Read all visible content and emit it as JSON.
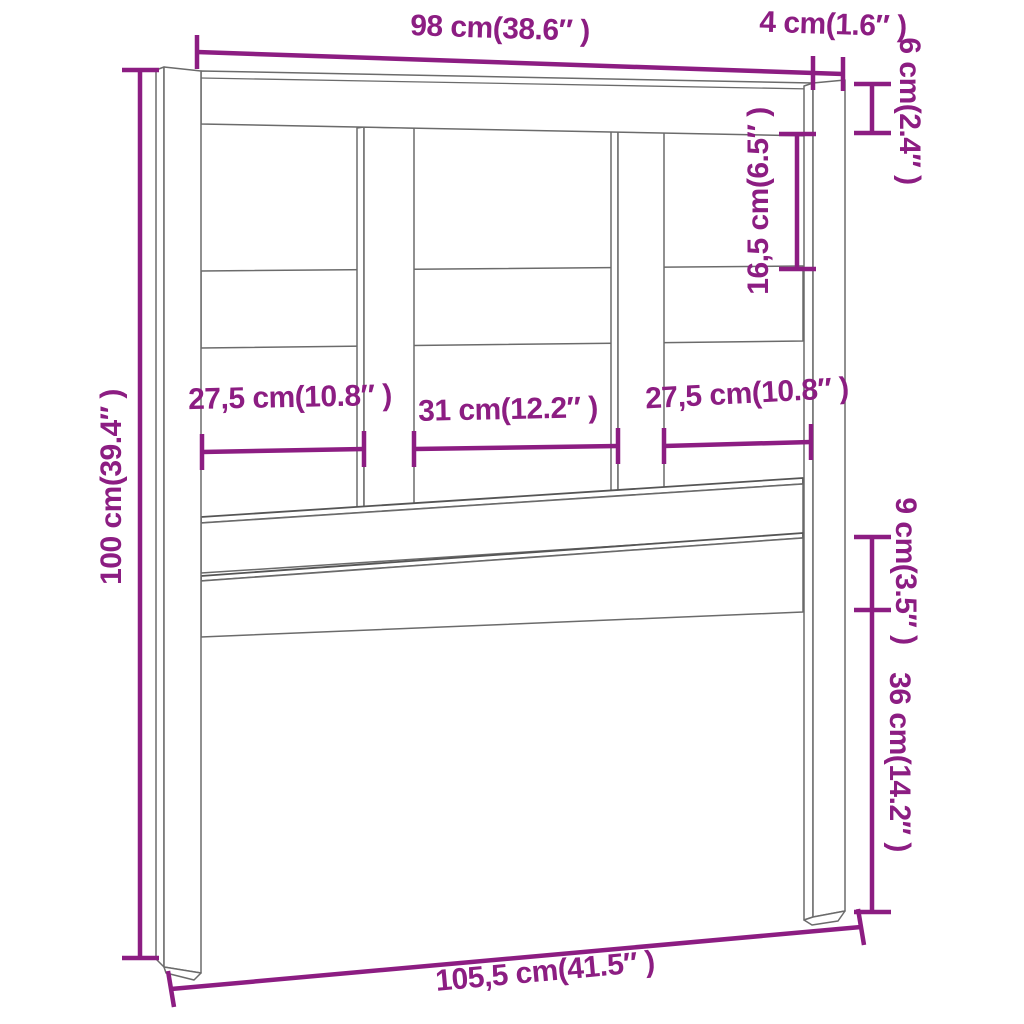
{
  "diagram": {
    "type": "furniture-dimension-diagram",
    "subject": "bed headboard line drawing with dimension annotations",
    "accent_color": "#8C1D82",
    "line_color": "#6b6b6b",
    "units": "cm (inches)",
    "dimensions": {
      "top_width": "98 cm(38.6″ )",
      "post_width": "4 cm(1.6″ )",
      "top_rail_height": "6 cm(2.4″ )",
      "upper_opening_height": "16,5 cm(6.5″ )",
      "total_height": "100 cm(39.4″ )",
      "left_opening_width": "27,5 cm(10.8″ )",
      "center_opening_width": "31 cm(12.2″ )",
      "right_opening_width": "27,5 cm(10.8″ )",
      "lower_board_height": "9 cm(3.5″ )",
      "leg_height": "36 cm(14.2″ )",
      "total_width": "105,5 cm(41.5″ )"
    }
  }
}
